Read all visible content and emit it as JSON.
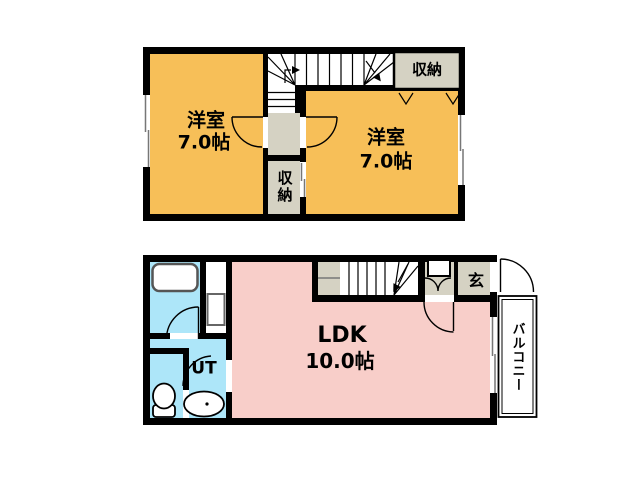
{
  "title": "2-story apartment floor plan",
  "floor2": {
    "room_left": {
      "name": "洋室",
      "size": "7.0帖"
    },
    "room_right": {
      "name": "洋室",
      "size": "7.0帖"
    },
    "closet_top": {
      "label": "収納"
    },
    "closet_mid": {
      "label": "収納"
    }
  },
  "floor1": {
    "ldk": {
      "name": "LDK",
      "size": "10.0帖"
    },
    "entrance": {
      "label": "玄"
    },
    "utility": {
      "label": "UT"
    },
    "balcony": {
      "label": "バルコニー"
    }
  },
  "colors": {
    "room": "#F7BF58",
    "ldk": "#F8CEC9",
    "wet": "#ADE6F9",
    "gray": "#D5D2C3",
    "wall": "#000000"
  }
}
